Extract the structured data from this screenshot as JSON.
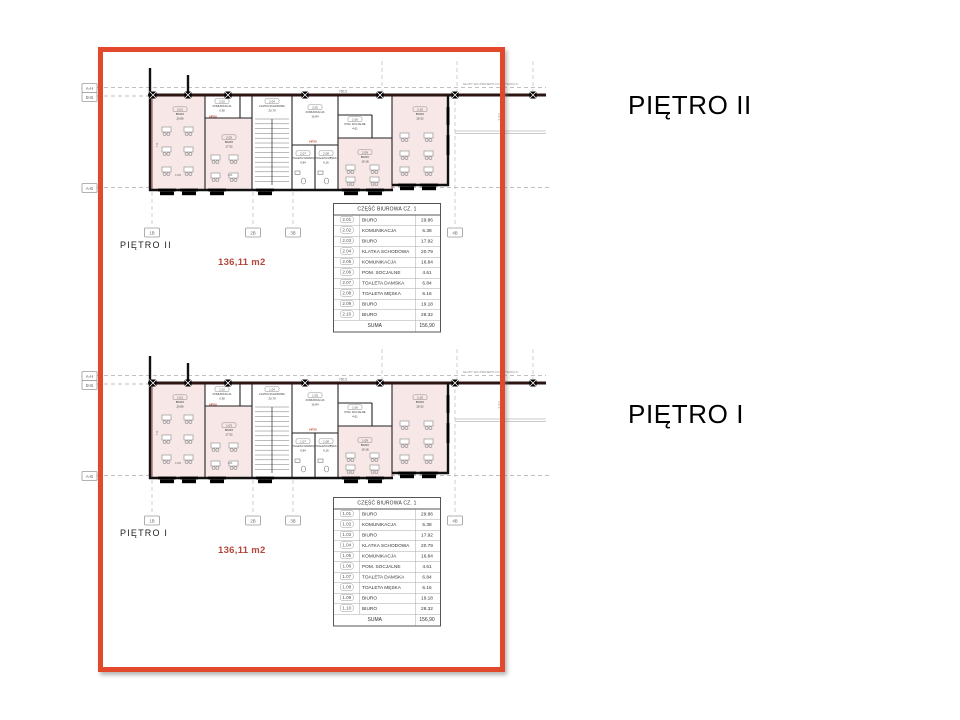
{
  "colors": {
    "frame_red": "#e2492c",
    "area_red": "#b4473c",
    "room_pink": "#f7e7e7",
    "masonry_red": "#7a2f28"
  },
  "floors": [
    {
      "id": "pietro-2",
      "big_title": "PIĘTRO II",
      "plan_label": "PIĘTRO II",
      "area_total": "136,11 m2",
      "construction_note": "SŁUPY WG PROJEKTU KONSTRUKCJI",
      "right_dimension": "7,57",
      "top_dimension": "760,5",
      "hp_label": "HP25",
      "axis_left": [
        "A-H",
        "B-B",
        "A-B"
      ],
      "axis_bottom": [
        "1B",
        "2B",
        "3B",
        "4B"
      ],
      "dims": [
        "4165",
        "345",
        "712"
      ],
      "table": {
        "header": "CZĘŚĆ BIUROWA CZ. 1",
        "rows": [
          {
            "no": "2.01",
            "name": "BIURO",
            "area": "29.86"
          },
          {
            "no": "2.02",
            "name": "KOMUNIKACJA",
            "area": "6.38"
          },
          {
            "no": "2.03",
            "name": "BIURO",
            "area": "17.92"
          },
          {
            "no": "2.04",
            "name": "KLATKA SCHODOWA",
            "area": "20.79"
          },
          {
            "no": "2.05",
            "name": "KOMUNIKACJA",
            "area": "16.84"
          },
          {
            "no": "2.06",
            "name": "POM. SOCJALNE",
            "area": "4.61"
          },
          {
            "no": "2.07",
            "name": "TOALETA DAMSKA",
            "area": "6.84"
          },
          {
            "no": "2.08",
            "name": "TOALETA MĘSKA",
            "area": "6.16"
          },
          {
            "no": "2.09",
            "name": "BIURO",
            "area": "19.18"
          },
          {
            "no": "2.10",
            "name": "BIURO",
            "area": "28.32"
          }
        ],
        "sum_label": "SUMA",
        "sum_value": "156,90"
      }
    },
    {
      "id": "pietro-1",
      "big_title": "PIĘTRO I",
      "plan_label": "PIĘTRO I",
      "area_total": "136,11 m2",
      "construction_note": "SŁUPY WG PROJEKTU KONSTRUKCJI",
      "right_dimension": "7,57",
      "top_dimension": "760,5",
      "hp_label": "HP25",
      "axis_left": [
        "A-H",
        "B-B",
        "A-B"
      ],
      "axis_bottom": [
        "1B",
        "2B",
        "3B",
        "4B"
      ],
      "dims": [
        "4165",
        "345",
        "712"
      ],
      "table": {
        "header": "CZĘŚĆ BIUROWA CZ. 1",
        "rows": [
          {
            "no": "1.01",
            "name": "BIURO",
            "area": "29.86"
          },
          {
            "no": "1.02",
            "name": "KOMUNIKACJA",
            "area": "6.38"
          },
          {
            "no": "1.03",
            "name": "BIURO",
            "area": "17.92"
          },
          {
            "no": "1.04",
            "name": "KLATKA SCHODOWA",
            "area": "20.79"
          },
          {
            "no": "1.05",
            "name": "KOMUNIKACJA",
            "area": "16.84"
          },
          {
            "no": "1.06",
            "name": "POM. SOCJALNE",
            "area": "4.61"
          },
          {
            "no": "1.07",
            "name": "TOALETA DAMSKA",
            "area": "6.84"
          },
          {
            "no": "1.08",
            "name": "TOALETA MĘSKA",
            "area": "6.16"
          },
          {
            "no": "1.09",
            "name": "BIURO",
            "area": "19.18"
          },
          {
            "no": "1.10",
            "name": "BIURO",
            "area": "28.32"
          }
        ],
        "sum_label": "SUMA",
        "sum_value": "156,90"
      }
    }
  ]
}
